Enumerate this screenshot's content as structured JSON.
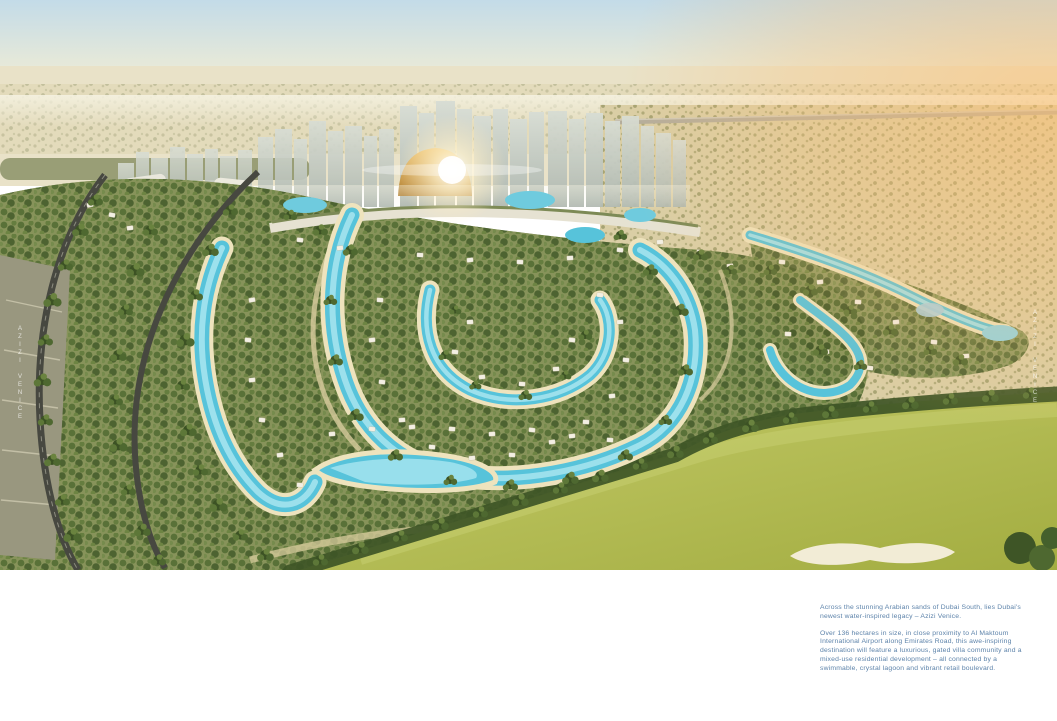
{
  "page": {
    "width": 1057,
    "height": 721,
    "background": "#ffffff"
  },
  "hero": {
    "alt": "Aerial masterplan render of Azizi Venice in Dubai South: crystal turquoise lagoons winding through gated villa clusters and palm greenery, a mixed-use high-rise skyline with a golden dome and sun glare, desert horizon with Emirates Road, curving access roads on the left and a golf course sweeping across the bottom right",
    "watermark": "AZIZI VENICE",
    "palette": {
      "sky_top": "#c3dbe8",
      "sky_horizon": "#f2efdd",
      "desert_band": "#e9e2c8",
      "desert_scrub": "#d9cda4",
      "warm_glow": "#ffbe6e",
      "skyline_tower": "#c6cdc5",
      "gold_dome": "#d9a94f",
      "community_green": "#87935a",
      "tree_dark": "#3c5224",
      "sand_path": "#d8cc9e",
      "lagoon": "#57c3da",
      "lagoon_light": "#a9e6f0",
      "beach": "#eee3bd",
      "villa": "#f3efe3",
      "golf_green": "#b5bd55",
      "bunker": "#f2ecd6",
      "road": "#474840"
    }
  },
  "caption": {
    "text_color": "#5d83aa",
    "p1": "Across the stunning Arabian sands of Dubai South, lies Dubai's newest water-inspired legacy – Azizi Venice.",
    "p2": "Over 136 hectares in size, in close proximity to Al Maktoum International Airport along Emirates Road, this awe-inspiring destination will feature a luxurious, gated villa community and a mixed-use residential development – all connected by a swimmable, crystal lagoon and vibrant retail boulevard."
  }
}
